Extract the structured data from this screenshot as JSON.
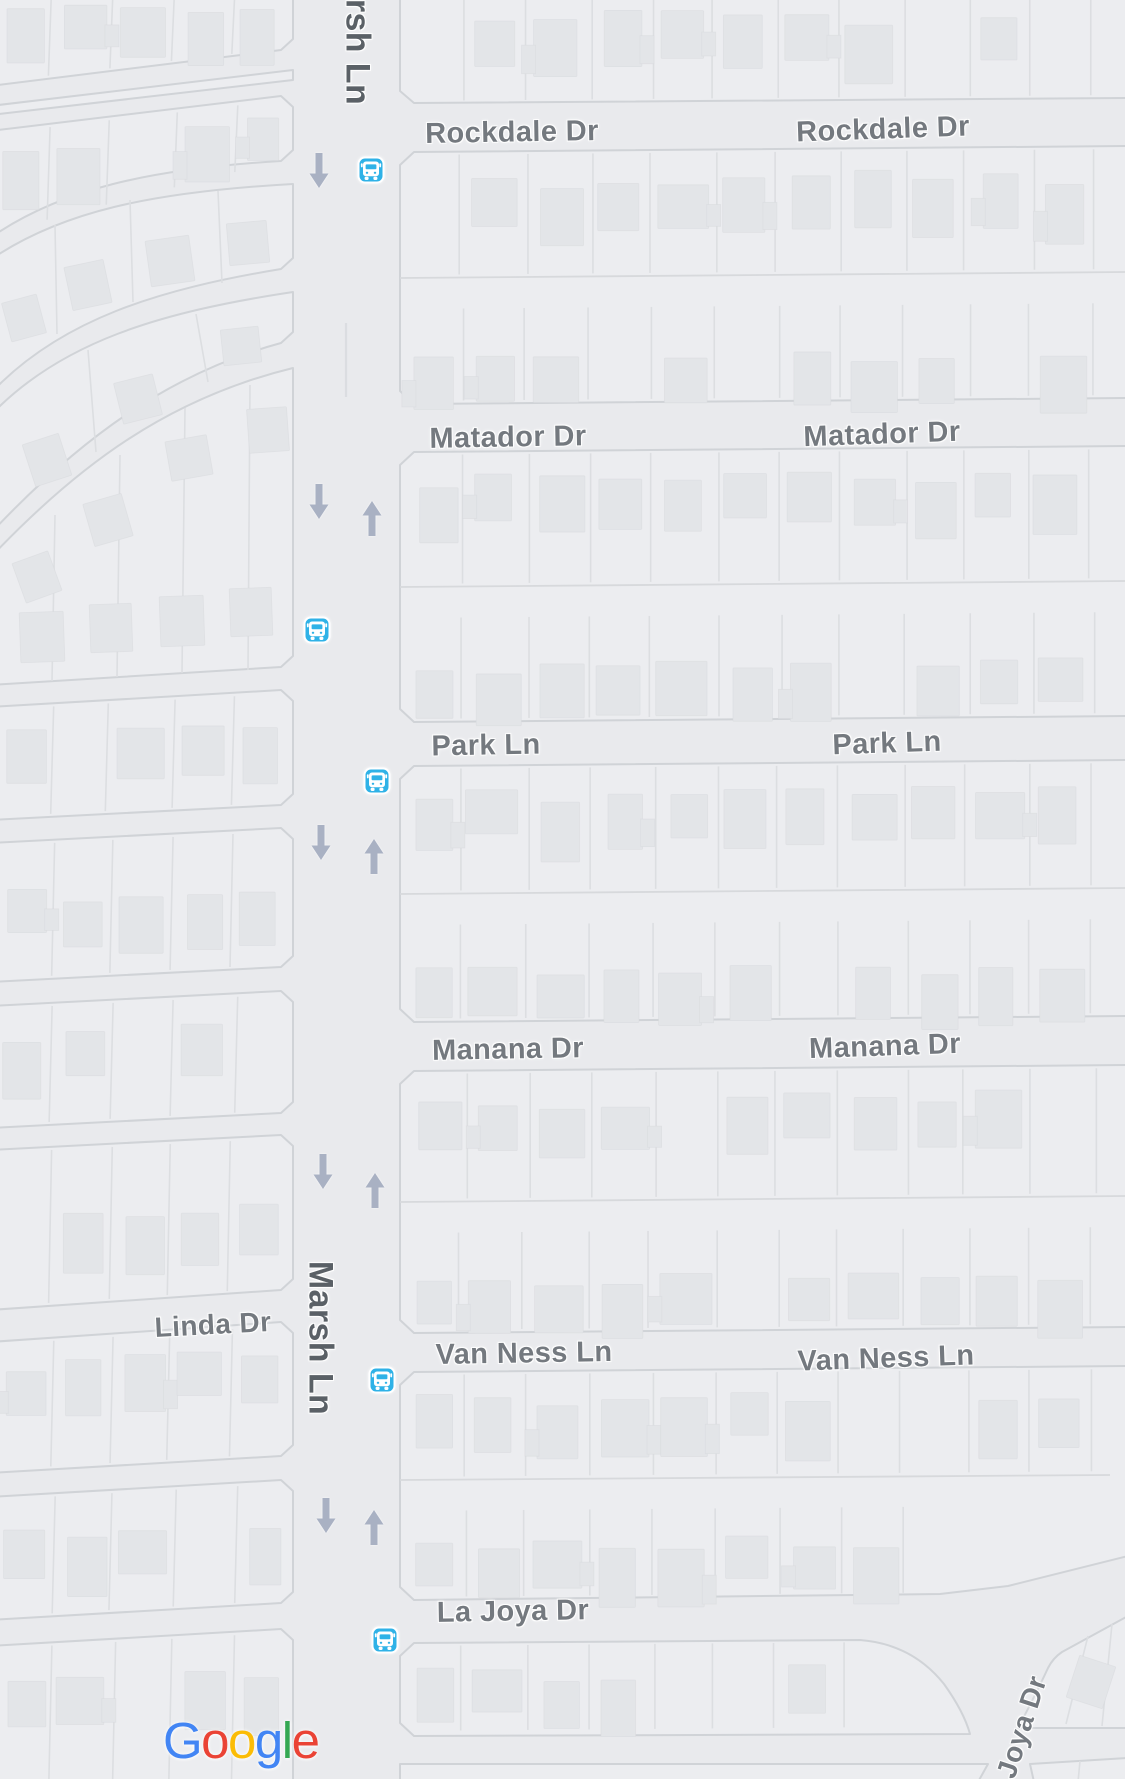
{
  "map": {
    "colors": {
      "land": "#e9eaed",
      "block": "#ecedf0",
      "road_casing": "#d0d3d7",
      "lot_line": "#dcdee1",
      "mid_line": "#d7d9dc",
      "building": "#e3e5e8",
      "building_edge": "#d7d9dd",
      "median": "#d8dade",
      "label": "#74797f",
      "label_dark": "#5a6066",
      "arrow": "#a9b1c3",
      "bus_blue": "#2fb2e7"
    },
    "street_labels": [
      {
        "id": "rockdale-dr-west",
        "text": "Rockdale Dr",
        "x": 512,
        "y": 133,
        "rot": -1,
        "size": 29,
        "dark": false
      },
      {
        "id": "rockdale-dr-east",
        "text": "Rockdale Dr",
        "x": 883,
        "y": 130,
        "rot": -2,
        "size": 29,
        "dark": false
      },
      {
        "id": "matador-dr-west",
        "text": "Matador Dr",
        "x": 508,
        "y": 438,
        "rot": -1,
        "size": 29,
        "dark": false
      },
      {
        "id": "matador-dr-east",
        "text": "Matador Dr",
        "x": 882,
        "y": 435,
        "rot": -2,
        "size": 29,
        "dark": false
      },
      {
        "id": "park-ln-west",
        "text": "Park Ln",
        "x": 486,
        "y": 746,
        "rot": -1,
        "size": 29,
        "dark": false
      },
      {
        "id": "park-ln-east",
        "text": "Park Ln",
        "x": 887,
        "y": 744,
        "rot": -2,
        "size": 29,
        "dark": false
      },
      {
        "id": "manana-dr-west",
        "text": "Manana Dr",
        "x": 508,
        "y": 1050,
        "rot": -1,
        "size": 29,
        "dark": false
      },
      {
        "id": "manana-dr-east",
        "text": "Manana Dr",
        "x": 885,
        "y": 1047,
        "rot": -2,
        "size": 29,
        "dark": false
      },
      {
        "id": "van-ness-ln-west",
        "text": "Van Ness Ln",
        "x": 524,
        "y": 1354,
        "rot": -1,
        "size": 29,
        "dark": false
      },
      {
        "id": "van-ness-ln-east",
        "text": "Van Ness Ln",
        "x": 886,
        "y": 1359,
        "rot": -2,
        "size": 29,
        "dark": false
      },
      {
        "id": "la-joya-dr-west",
        "text": "La Joya Dr",
        "x": 513,
        "y": 1612,
        "rot": -1,
        "size": 29,
        "dark": false
      },
      {
        "id": "linda-dr",
        "text": "Linda Dr",
        "x": 213,
        "y": 1325,
        "rot": -3,
        "size": 28,
        "dark": false
      },
      {
        "id": "marsh-ln-north",
        "text": "rsh Ln",
        "x": 357,
        "y": 52,
        "rot": 90,
        "size": 34,
        "dark": true
      },
      {
        "id": "marsh-ln-mid",
        "text": "Marsh Ln",
        "x": 320,
        "y": 1338,
        "rot": 90,
        "size": 34,
        "dark": true
      },
      {
        "id": "joya-dr-south",
        "text": "Joya Dr",
        "x": 1022,
        "y": 1727,
        "rot": -72,
        "size": 28,
        "dark": false
      }
    ],
    "bus_stops": [
      {
        "id": "bus-stop-rockdale",
        "x": 371,
        "y": 170
      },
      {
        "id": "bus-stop-marsh-mid",
        "x": 317,
        "y": 630
      },
      {
        "id": "bus-stop-park",
        "x": 377,
        "y": 781
      },
      {
        "id": "bus-stop-van-ness",
        "x": 382,
        "y": 1380
      },
      {
        "id": "bus-stop-la-joya",
        "x": 385,
        "y": 1640
      }
    ],
    "traffic_arrows": [
      {
        "x": 319,
        "y": 152,
        "dir": "down"
      },
      {
        "x": 319,
        "y": 483,
        "dir": "down"
      },
      {
        "x": 372,
        "y": 500,
        "dir": "up"
      },
      {
        "x": 321,
        "y": 824,
        "dir": "down"
      },
      {
        "x": 374,
        "y": 838,
        "dir": "up"
      },
      {
        "x": 323,
        "y": 1153,
        "dir": "down"
      },
      {
        "x": 375,
        "y": 1172,
        "dir": "up"
      },
      {
        "x": 326,
        "y": 1497,
        "dir": "down"
      },
      {
        "x": 374,
        "y": 1509,
        "dir": "up"
      }
    ],
    "median_segments": [
      {
        "x": 346,
        "y1": 323,
        "y2": 397
      }
    ],
    "provider_logo": {
      "text": "Google",
      "letters": [
        {
          "ch": "G",
          "color": "#4285F4"
        },
        {
          "ch": "o",
          "color": "#EA4335"
        },
        {
          "ch": "o",
          "color": "#FBBC05"
        },
        {
          "ch": "g",
          "color": "#4285F4"
        },
        {
          "ch": "l",
          "color": "#34A853"
        },
        {
          "ch": "e",
          "color": "#EA4335"
        }
      ]
    }
  }
}
